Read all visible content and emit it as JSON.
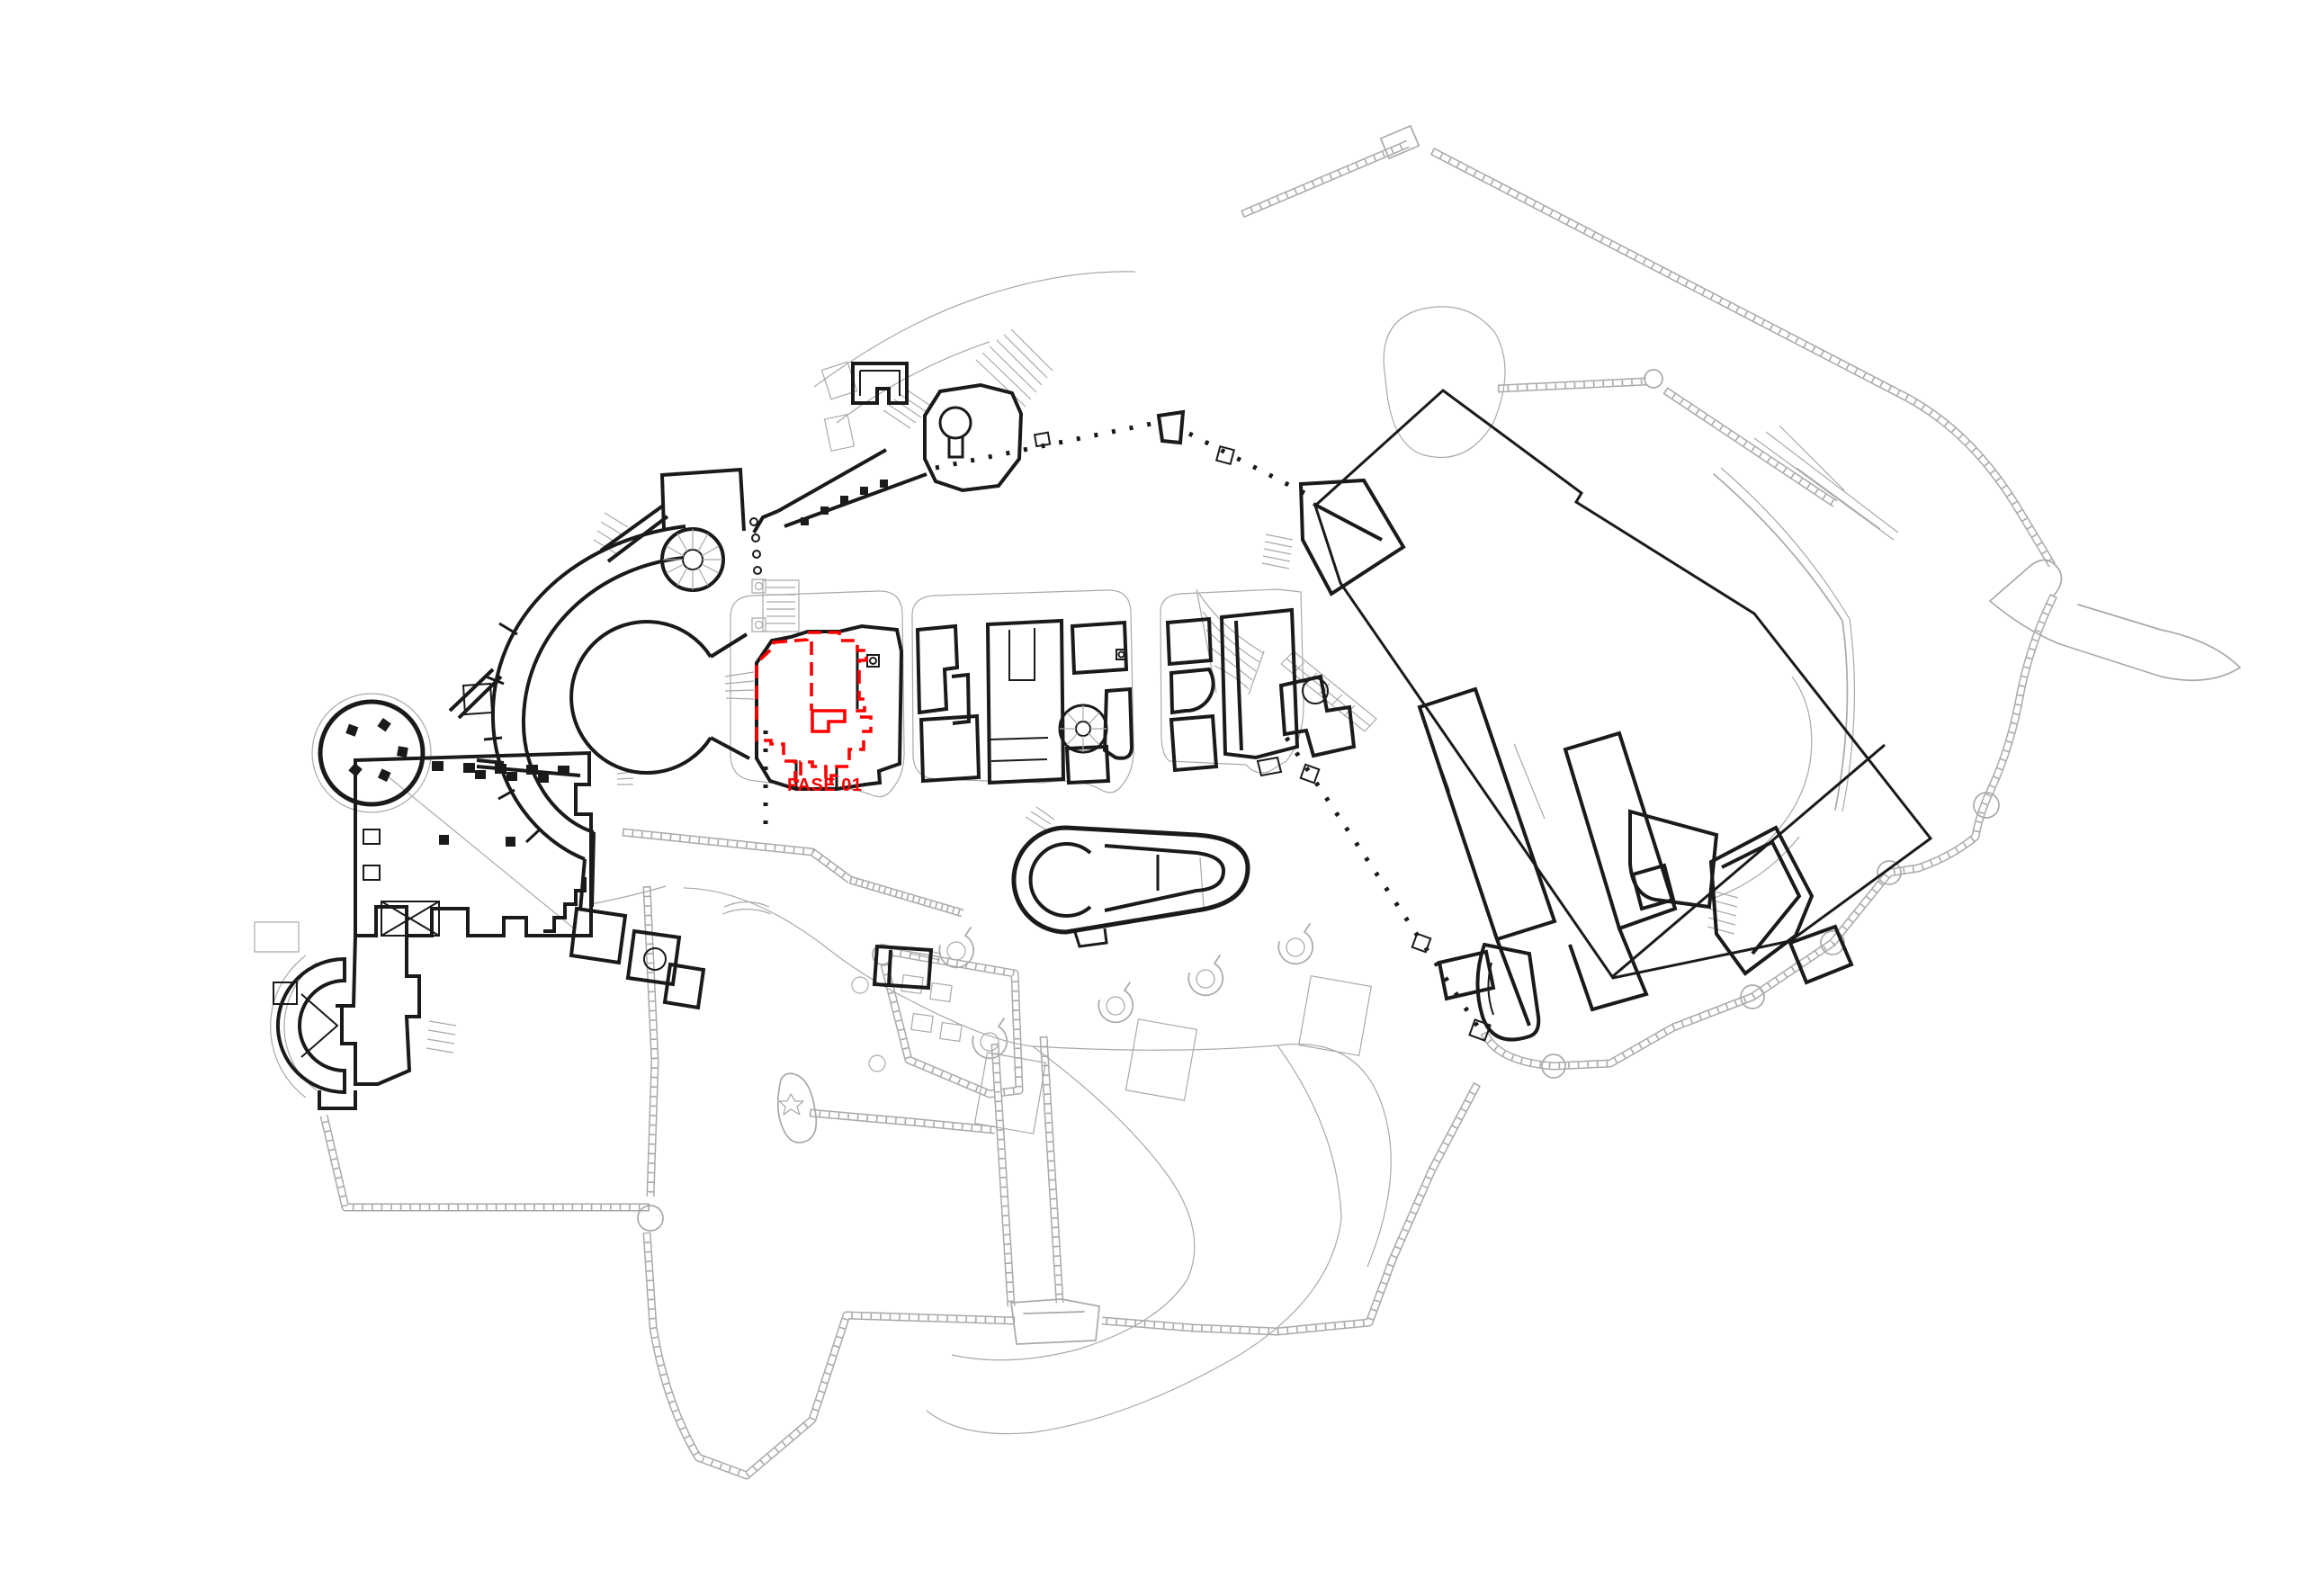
{
  "plan": {
    "phase_label": "FASE 01",
    "type": "castle-site-plan"
  },
  "colors": {
    "wall_ink": "#1a1a1a",
    "site_line": "#a9a9a9",
    "highlight_red": "#ff0000",
    "background": "#ffffff"
  }
}
